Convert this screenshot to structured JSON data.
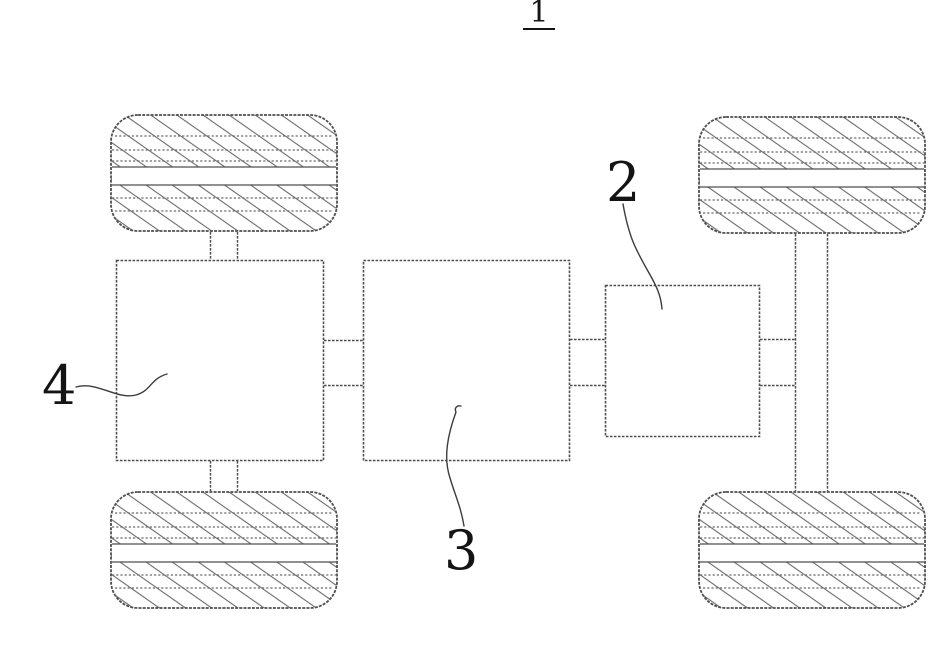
{
  "figure": {
    "number": "1",
    "parts": [
      {
        "ref": "2"
      },
      {
        "ref": "3"
      },
      {
        "ref": "4"
      }
    ]
  },
  "colors": {
    "background": "#ffffff",
    "line": "#4f4f4f",
    "hatch": "#6a6a6a",
    "text": "#141414",
    "leader": "#3c3c3c"
  }
}
